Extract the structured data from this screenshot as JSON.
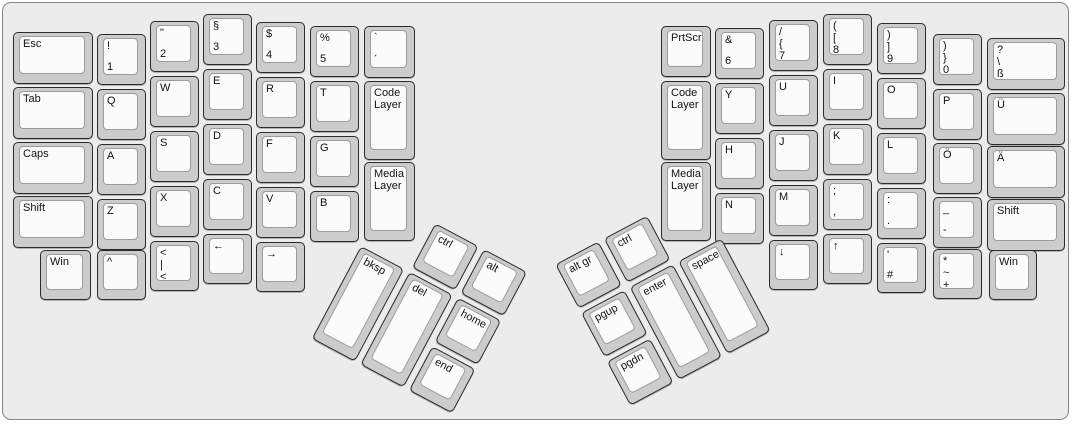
{
  "colors": {
    "canvas_bg": "#ececec",
    "key_side": "#cccccc",
    "key_top": "#fbfbfb",
    "outline": "#2b2b2b",
    "legend": "#111111"
  },
  "keyboard": {
    "groups": [
      {
        "name": "left-main-block",
        "origin_x": 0,
        "origin_y": 0,
        "rotation": 0,
        "keys": [
          {
            "id": "esc",
            "x": 10,
            "y": 29,
            "w": 80,
            "h": 52,
            "labels": [
              "Esc"
            ]
          },
          {
            "id": "tab",
            "x": 10,
            "y": 84,
            "w": 80,
            "h": 52,
            "labels": [
              "Tab"
            ]
          },
          {
            "id": "caps",
            "x": 10,
            "y": 139,
            "w": 80,
            "h": 52,
            "labels": [
              "Caps"
            ]
          },
          {
            "id": "shift-left",
            "x": 10,
            "y": 193,
            "w": 80,
            "h": 52,
            "labels": [
              "Shift"
            ]
          },
          {
            "id": "win-left",
            "x": 37,
            "y": 247,
            "w": 51,
            "h": 50,
            "labels": [
              "Win"
            ]
          },
          {
            "id": "1",
            "x": 94,
            "y": 31,
            "w": 49,
            "h": 51,
            "labels": [
              "!",
              "1"
            ]
          },
          {
            "id": "q",
            "x": 94,
            "y": 86,
            "w": 49,
            "h": 51,
            "labels": [
              "Q"
            ]
          },
          {
            "id": "a",
            "x": 94,
            "y": 141,
            "w": 49,
            "h": 51,
            "labels": [
              "A"
            ]
          },
          {
            "id": "z",
            "x": 94,
            "y": 196,
            "w": 49,
            "h": 51,
            "labels": [
              "Z"
            ]
          },
          {
            "id": "caret",
            "x": 94,
            "y": 247,
            "w": 49,
            "h": 50,
            "labels": [
              "^"
            ]
          },
          {
            "id": "2",
            "x": 147,
            "y": 18,
            "w": 49,
            "h": 51,
            "labels": [
              "\"",
              "2"
            ]
          },
          {
            "id": "w",
            "x": 147,
            "y": 73,
            "w": 49,
            "h": 51,
            "labels": [
              "W"
            ]
          },
          {
            "id": "s",
            "x": 147,
            "y": 128,
            "w": 49,
            "h": 51,
            "labels": [
              "S"
            ]
          },
          {
            "id": "x",
            "x": 147,
            "y": 183,
            "w": 49,
            "h": 51,
            "labels": [
              "X"
            ]
          },
          {
            "id": "less-pipe",
            "x": 147,
            "y": 238,
            "w": 49,
            "h": 50,
            "labels": [
              "<",
              "|",
              "<"
            ]
          },
          {
            "id": "3",
            "x": 200,
            "y": 11,
            "w": 49,
            "h": 51,
            "labels": [
              "§",
              "3"
            ]
          },
          {
            "id": "e",
            "x": 200,
            "y": 66,
            "w": 49,
            "h": 51,
            "labels": [
              "E"
            ]
          },
          {
            "id": "d",
            "x": 200,
            "y": 121,
            "w": 49,
            "h": 51,
            "labels": [
              "D"
            ]
          },
          {
            "id": "c",
            "x": 200,
            "y": 176,
            "w": 49,
            "h": 51,
            "labels": [
              "C"
            ]
          },
          {
            "id": "arrow-left",
            "x": 200,
            "y": 231,
            "w": 49,
            "h": 50,
            "labels": [
              "←"
            ]
          },
          {
            "id": "4",
            "x": 253,
            "y": 19,
            "w": 49,
            "h": 51,
            "labels": [
              "$",
              "4"
            ]
          },
          {
            "id": "r",
            "x": 253,
            "y": 74,
            "w": 49,
            "h": 51,
            "labels": [
              "R"
            ]
          },
          {
            "id": "f",
            "x": 253,
            "y": 129,
            "w": 49,
            "h": 51,
            "labels": [
              "F"
            ]
          },
          {
            "id": "v",
            "x": 253,
            "y": 184,
            "w": 49,
            "h": 51,
            "labels": [
              "V"
            ]
          },
          {
            "id": "arrow-right",
            "x": 253,
            "y": 239,
            "w": 49,
            "h": 50,
            "labels": [
              "→"
            ]
          },
          {
            "id": "5",
            "x": 307,
            "y": 23,
            "w": 49,
            "h": 51,
            "labels": [
              "%",
              "5"
            ]
          },
          {
            "id": "t",
            "x": 307,
            "y": 78,
            "w": 49,
            "h": 51,
            "labels": [
              "T"
            ]
          },
          {
            "id": "g",
            "x": 307,
            "y": 133,
            "w": 49,
            "h": 51,
            "labels": [
              "G"
            ]
          },
          {
            "id": "b",
            "x": 307,
            "y": 188,
            "w": 49,
            "h": 51,
            "labels": [
              "B"
            ]
          },
          {
            "id": "grave-acute",
            "x": 361,
            "y": 23,
            "w": 51,
            "h": 52,
            "labels": [
              "`",
              "´"
            ]
          },
          {
            "id": "code-layer-left",
            "x": 361,
            "y": 78,
            "w": 51,
            "h": 79,
            "labels": [
              "Code Layer"
            ]
          },
          {
            "id": "media-layer-left",
            "x": 361,
            "y": 159,
            "w": 51,
            "h": 79,
            "labels": [
              "Media Layer"
            ]
          }
        ]
      },
      {
        "name": "right-main-block",
        "origin_x": 0,
        "origin_y": 0,
        "rotation": 0,
        "keys": [
          {
            "id": "prtscr",
            "x": 658,
            "y": 23,
            "w": 50,
            "h": 51,
            "labels": [
              "PrtScr"
            ]
          },
          {
            "id": "code-layer-right",
            "x": 658,
            "y": 78,
            "w": 50,
            "h": 79,
            "labels": [
              "Code Layer"
            ]
          },
          {
            "id": "media-layer-right",
            "x": 658,
            "y": 159,
            "w": 50,
            "h": 79,
            "labels": [
              "Media Layer"
            ]
          },
          {
            "id": "6",
            "x": 712,
            "y": 25,
            "w": 49,
            "h": 51,
            "labels": [
              "&",
              "6"
            ]
          },
          {
            "id": "y",
            "x": 712,
            "y": 80,
            "w": 49,
            "h": 51,
            "labels": [
              "Y"
            ]
          },
          {
            "id": "h",
            "x": 712,
            "y": 135,
            "w": 49,
            "h": 51,
            "labels": [
              "H"
            ]
          },
          {
            "id": "n",
            "x": 712,
            "y": 190,
            "w": 49,
            "h": 51,
            "labels": [
              "N"
            ]
          },
          {
            "id": "7",
            "x": 766,
            "y": 17,
            "w": 49,
            "h": 51,
            "labels": [
              "/",
              "{",
              "7"
            ]
          },
          {
            "id": "u",
            "x": 766,
            "y": 72,
            "w": 49,
            "h": 51,
            "labels": [
              "U"
            ]
          },
          {
            "id": "j",
            "x": 766,
            "y": 127,
            "w": 49,
            "h": 51,
            "labels": [
              "J"
            ]
          },
          {
            "id": "m",
            "x": 766,
            "y": 182,
            "w": 49,
            "h": 51,
            "labels": [
              "M"
            ]
          },
          {
            "id": "arrow-down",
            "x": 766,
            "y": 237,
            "w": 49,
            "h": 50,
            "labels": [
              "↓"
            ]
          },
          {
            "id": "8",
            "x": 820,
            "y": 11,
            "w": 49,
            "h": 51,
            "labels": [
              "(",
              "[",
              "8"
            ]
          },
          {
            "id": "i",
            "x": 820,
            "y": 66,
            "w": 49,
            "h": 51,
            "labels": [
              "I"
            ]
          },
          {
            "id": "k",
            "x": 820,
            "y": 121,
            "w": 49,
            "h": 51,
            "labels": [
              "K"
            ]
          },
          {
            "id": "semicolon-comma",
            "x": 820,
            "y": 176,
            "w": 49,
            "h": 51,
            "labels": [
              ";",
              ","
            ]
          },
          {
            "id": "arrow-up",
            "x": 820,
            "y": 231,
            "w": 49,
            "h": 50,
            "labels": [
              "↑"
            ]
          },
          {
            "id": "9",
            "x": 874,
            "y": 20,
            "w": 49,
            "h": 51,
            "labels": [
              ")",
              "]",
              "9"
            ]
          },
          {
            "id": "o",
            "x": 874,
            "y": 75,
            "w": 49,
            "h": 51,
            "labels": [
              "O"
            ]
          },
          {
            "id": "l",
            "x": 874,
            "y": 130,
            "w": 49,
            "h": 51,
            "labels": [
              "L"
            ]
          },
          {
            "id": "colon-period",
            "x": 874,
            "y": 185,
            "w": 49,
            "h": 51,
            "labels": [
              ":",
              "."
            ]
          },
          {
            "id": "quote-hash",
            "x": 874,
            "y": 240,
            "w": 49,
            "h": 50,
            "labels": [
              "'",
              "#"
            ]
          },
          {
            "id": "0",
            "x": 930,
            "y": 31,
            "w": 49,
            "h": 51,
            "labels": [
              ")",
              "}",
              "0"
            ]
          },
          {
            "id": "p",
            "x": 930,
            "y": 86,
            "w": 49,
            "h": 51,
            "labels": [
              "P"
            ]
          },
          {
            "id": "o-umlaut",
            "x": 930,
            "y": 140,
            "w": 49,
            "h": 51,
            "labels": [
              "Ö"
            ]
          },
          {
            "id": "underscore-hyphen",
            "x": 930,
            "y": 194,
            "w": 49,
            "h": 51,
            "labels": [
              "_",
              "-"
            ]
          },
          {
            "id": "asterisk-tilde-plus",
            "x": 930,
            "y": 246,
            "w": 49,
            "h": 50,
            "labels": [
              "*",
              "~",
              "+"
            ]
          },
          {
            "id": "question-eszett",
            "x": 984,
            "y": 35,
            "w": 78,
            "h": 52,
            "labels": [
              "?",
              "\\",
              "ß"
            ]
          },
          {
            "id": "u-umlaut",
            "x": 984,
            "y": 90,
            "w": 78,
            "h": 52,
            "labels": [
              "Ü"
            ]
          },
          {
            "id": "a-umlaut",
            "x": 984,
            "y": 143,
            "w": 78,
            "h": 52,
            "labels": [
              "Ä"
            ]
          },
          {
            "id": "shift-right",
            "x": 984,
            "y": 196,
            "w": 78,
            "h": 52,
            "labels": [
              "Shift"
            ]
          },
          {
            "id": "win-right",
            "x": 986,
            "y": 247,
            "w": 48,
            "h": 50,
            "labels": [
              "Win"
            ]
          }
        ]
      },
      {
        "name": "left-thumb-cluster",
        "origin_x": 358,
        "origin_y": 243,
        "rotation": 28,
        "keys": [
          {
            "id": "ctrl-left",
            "x": 55,
            "y": -55,
            "w": 49,
            "h": 50,
            "labels": [
              "ctrl"
            ]
          },
          {
            "id": "alt",
            "x": 110,
            "y": -55,
            "w": 49,
            "h": 50,
            "labels": [
              "alt"
            ]
          },
          {
            "id": "bksp",
            "x": 0,
            "y": 0,
            "w": 49,
            "h": 105,
            "labels": [
              "bksp"
            ]
          },
          {
            "id": "del",
            "x": 55,
            "y": 0,
            "w": 49,
            "h": 105,
            "labels": [
              "del"
            ]
          },
          {
            "id": "home",
            "x": 110,
            "y": 0,
            "w": 49,
            "h": 50,
            "labels": [
              "home"
            ]
          },
          {
            "id": "end",
            "x": 110,
            "y": 55,
            "w": 49,
            "h": 50,
            "labels": [
              "end"
            ]
          }
        ]
      },
      {
        "name": "right-thumb-cluster",
        "origin_x": 578,
        "origin_y": 310,
        "rotation": -28,
        "keys": [
          {
            "id": "alt-gr",
            "x": 0,
            "y": -55,
            "w": 49,
            "h": 50,
            "labels": [
              "alt gr"
            ]
          },
          {
            "id": "ctrl-right",
            "x": 55,
            "y": -55,
            "w": 49,
            "h": 50,
            "labels": [
              "ctrl"
            ]
          },
          {
            "id": "pgup",
            "x": 0,
            "y": 0,
            "w": 49,
            "h": 50,
            "labels": [
              "pgup"
            ]
          },
          {
            "id": "pgdn",
            "x": 0,
            "y": 55,
            "w": 49,
            "h": 50,
            "labels": [
              "pgdn"
            ]
          },
          {
            "id": "enter",
            "x": 55,
            "y": 0,
            "w": 49,
            "h": 105,
            "labels": [
              "enter"
            ]
          },
          {
            "id": "space",
            "x": 110,
            "y": 0,
            "w": 49,
            "h": 105,
            "labels": [
              "space"
            ]
          }
        ]
      }
    ]
  }
}
